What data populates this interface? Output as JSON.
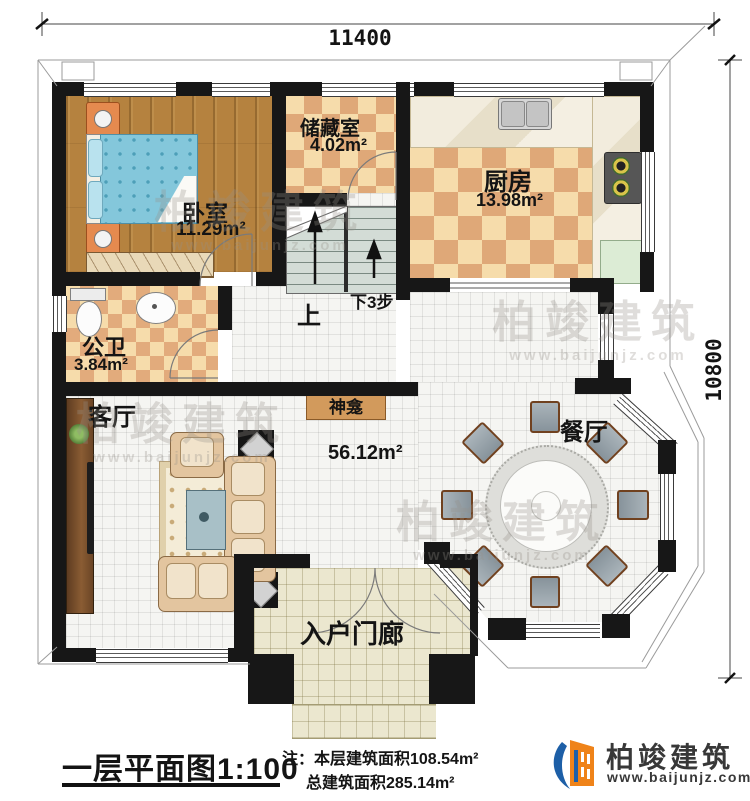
{
  "dimensions": {
    "width": "11400",
    "height": "10800"
  },
  "rooms": {
    "bedroom": {
      "label": "卧室",
      "area": "11.29m²"
    },
    "storage": {
      "label": "储藏室",
      "area": "4.02m²"
    },
    "kitchen": {
      "label": "厨房",
      "area": "13.98m²"
    },
    "bathroom": {
      "label": "公卫",
      "area": "3.84m²"
    },
    "living": {
      "label": "客厅",
      "area": "56.12m²"
    },
    "dining": {
      "label": "餐厅"
    },
    "shrine": {
      "label": "神龛"
    },
    "porch": {
      "label": "入户门廊"
    }
  },
  "stairs": {
    "up": "上",
    "down": "下3步"
  },
  "watermark": {
    "brand": "柏竣建筑",
    "site": "www.baijunjz.com"
  },
  "footer": {
    "plan_title": "一层平面图",
    "scale": "1:100",
    "note1": "注：本层建筑面积108.54m²",
    "note2": "总建筑面积285.14m²",
    "brand": "柏竣建筑",
    "site": "www.baijunjz.com"
  },
  "colors": {
    "wall": "#171717",
    "checker_light": "#f6dcab",
    "checker_dark": "#dfa878",
    "wood_floor": "#b5823f",
    "living_tile": "#f5f5f2",
    "porch_tile": "#ebe7cf",
    "brand_blue": "#1d5fa7",
    "brand_orange": "#ef8319"
  }
}
